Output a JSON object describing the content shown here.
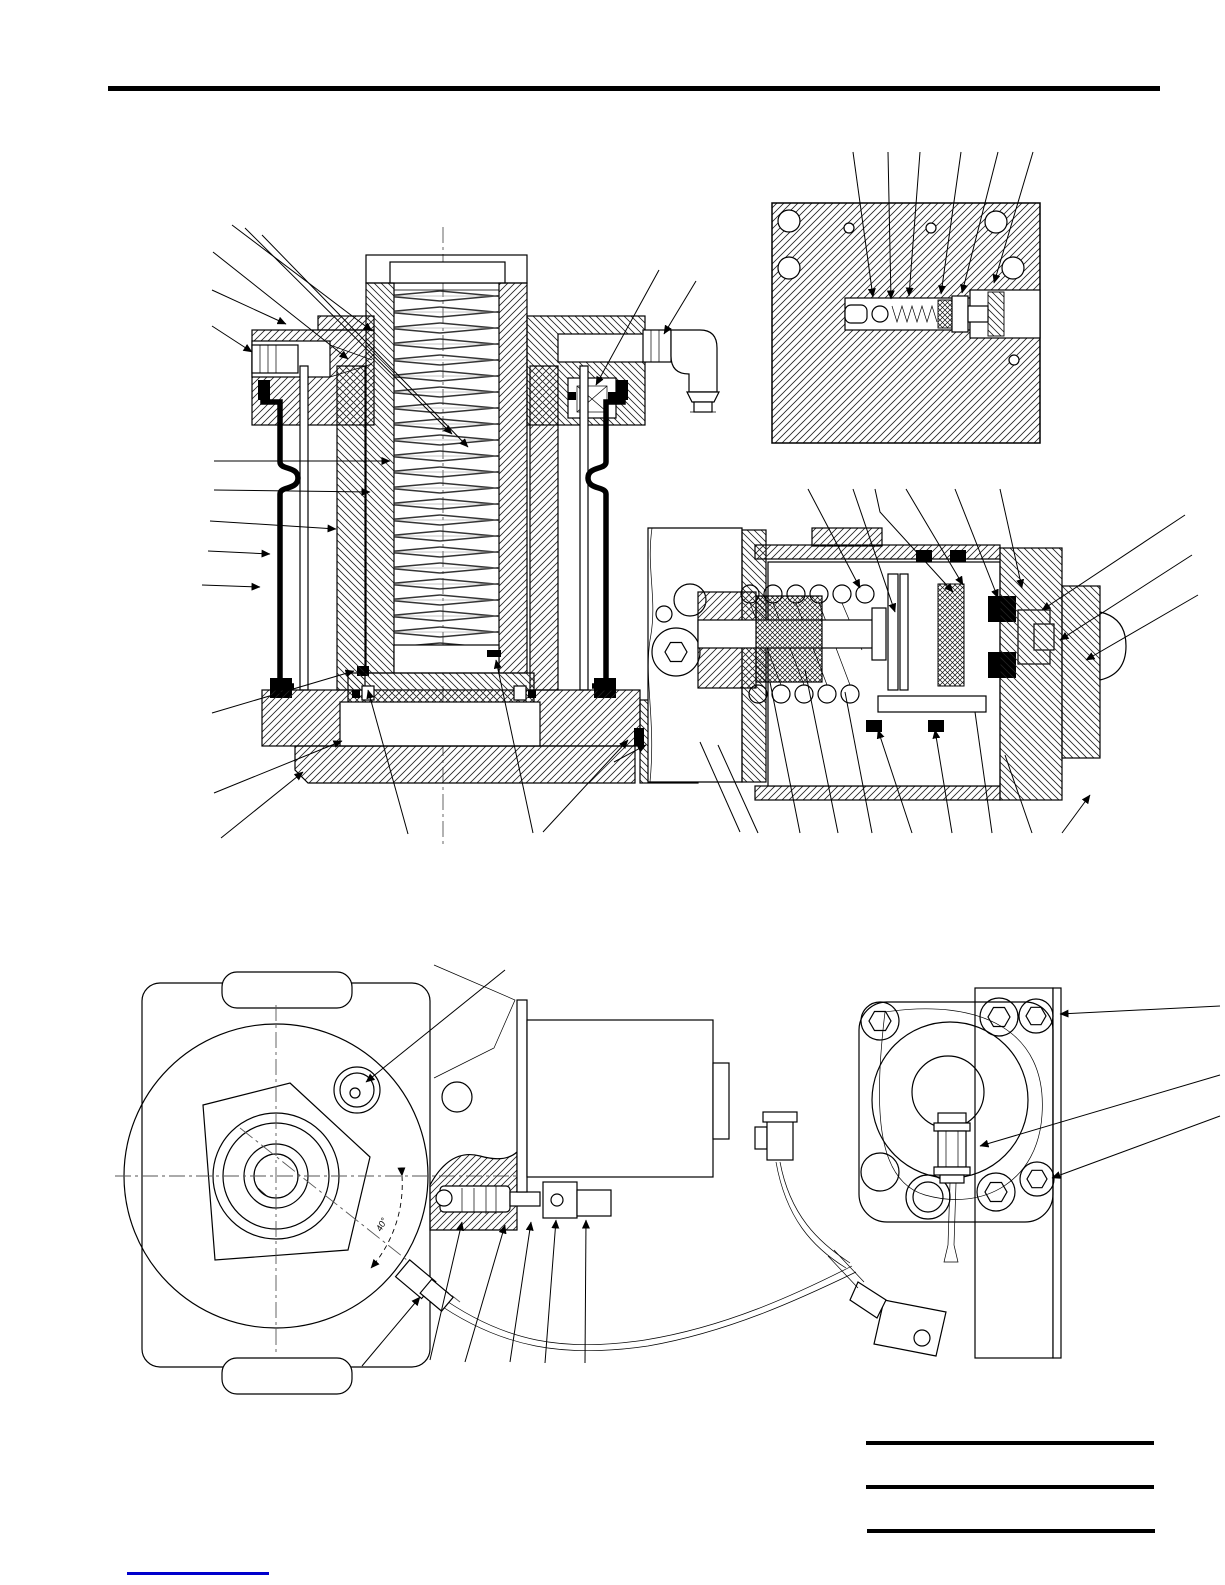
{
  "page": {
    "background_color": "#ffffff",
    "ink_color": "#000000",
    "rule_color": "#000000"
  },
  "figures": {
    "front_view": {
      "angle_label": "40°"
    }
  },
  "reference_lines": {
    "count": 3
  },
  "footer": {
    "link_underline_color": "#0000cc"
  }
}
